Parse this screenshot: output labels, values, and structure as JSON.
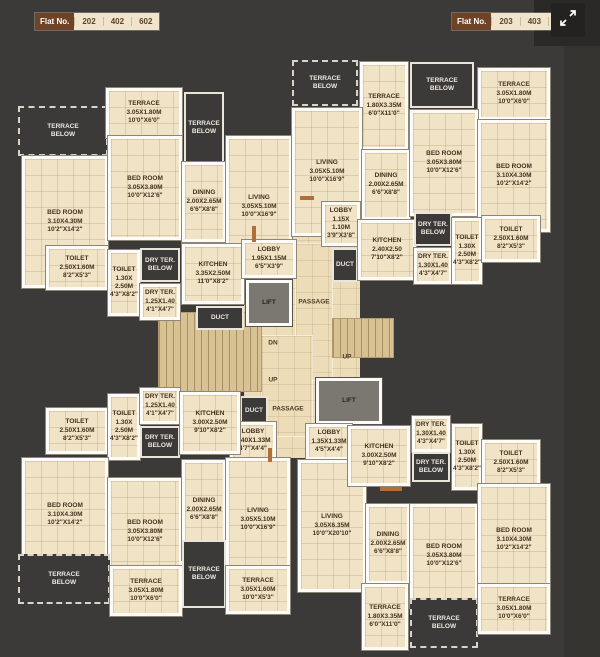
{
  "header": {
    "left_badge": {
      "label": "Flat No.",
      "numbers": [
        "202",
        "402",
        "602"
      ]
    },
    "right_badge": {
      "label": "Flat No.",
      "numbers": [
        "203",
        "403",
        "603"
      ]
    },
    "expand_icon": "expand-arrows-icon"
  },
  "colors": {
    "background": "#3b3a38",
    "room_cream": "#f1e3c6",
    "wall_white": "#fcfbf7",
    "badge_brown": "#6f4426",
    "lift_gray": "#7b7871",
    "stair_tan": "#d8c192",
    "label_brown": "#43321f"
  },
  "plan": {
    "rooms": [
      {
        "id": "core-floor-upper",
        "kind": "corefloor",
        "x": 244,
        "y": 208,
        "w": 116,
        "h": 250,
        "lines": []
      },
      {
        "id": "passage-upper",
        "kind": "passage",
        "x": 296,
        "y": 244,
        "w": 36,
        "h": 136,
        "lines": []
      },
      {
        "id": "passage-lower",
        "kind": "passage",
        "x": 262,
        "y": 336,
        "w": 50,
        "h": 100,
        "lines": []
      },
      {
        "id": "stair-left",
        "kind": "stair",
        "x": 158,
        "y": 312,
        "w": 104,
        "h": 80,
        "lines": []
      },
      {
        "id": "stair-right",
        "kind": "stair",
        "x": 332,
        "y": 318,
        "w": 62,
        "h": 40,
        "lines": []
      },
      {
        "id": "tl-terrace-below-left",
        "kind": "dark-dashed",
        "x": 18,
        "y": 106,
        "w": 90,
        "h": 50,
        "lines": [
          "TERRACE",
          "BELOW"
        ]
      },
      {
        "id": "tl-terrace",
        "kind": "room",
        "x": 106,
        "y": 88,
        "w": 76,
        "h": 50,
        "lines": [
          "TERRACE",
          "3.05X1.80M",
          "10'0\"X6'0\""
        ]
      },
      {
        "id": "tl-terrace-below-mid",
        "kind": "dark",
        "x": 184,
        "y": 92,
        "w": 40,
        "h": 72,
        "lines": [
          "TERRACE",
          "BELOW"
        ]
      },
      {
        "id": "tl-bedroom-left",
        "kind": "room",
        "x": 22,
        "y": 156,
        "w": 86,
        "h": 132,
        "lines": [
          "BED ROOM",
          "3.10X4.30M",
          "10'2\"X14'2\""
        ]
      },
      {
        "id": "tl-bedroom-mid",
        "kind": "room",
        "x": 108,
        "y": 136,
        "w": 74,
        "h": 104,
        "lines": [
          "BED ROOM",
          "3.05X3.80M",
          "10'0\"X12'6\""
        ]
      },
      {
        "id": "tl-dining",
        "kind": "room",
        "x": 182,
        "y": 162,
        "w": 44,
        "h": 80,
        "lines": [
          "DINING",
          "2.00X2.65M",
          "6'6\"X8'8\""
        ]
      },
      {
        "id": "tl-living",
        "kind": "room",
        "x": 226,
        "y": 136,
        "w": 66,
        "h": 142,
        "lines": [
          "LIVING",
          "3.05X5.10M",
          "10'0\"X16'9\""
        ]
      },
      {
        "id": "tl-toilet-1",
        "kind": "room",
        "x": 46,
        "y": 246,
        "w": 62,
        "h": 44,
        "lines": [
          "TOILET",
          "2.50X1.60M",
          "8'2\"X5'3\""
        ]
      },
      {
        "id": "tl-toilet-2",
        "kind": "room",
        "x": 108,
        "y": 250,
        "w": 32,
        "h": 66,
        "lines": [
          "TOILET",
          "1.30X",
          "2.50M",
          "4'3\"X8'2\""
        ]
      },
      {
        "id": "tl-dry-terrace-below",
        "kind": "dark",
        "x": 140,
        "y": 248,
        "w": 40,
        "h": 34,
        "lines": [
          "DRY TER.",
          "BELOW"
        ]
      },
      {
        "id": "tl-dry-terrace",
        "kind": "room",
        "x": 140,
        "y": 284,
        "w": 40,
        "h": 36,
        "lines": [
          "DRY TER.",
          "1.25X1.40",
          "4'1\"X4'7\""
        ]
      },
      {
        "id": "tl-kitchen",
        "kind": "room",
        "x": 182,
        "y": 244,
        "w": 62,
        "h": 60,
        "lines": [
          "KITCHEN",
          "3.35X2.50M",
          "11'0\"X8'2\""
        ]
      },
      {
        "id": "tl-duct",
        "kind": "dark",
        "x": 196,
        "y": 306,
        "w": 48,
        "h": 24,
        "lines": [
          "DUCT"
        ]
      },
      {
        "id": "tr-terrace-below-left",
        "kind": "dark-dashed",
        "x": 292,
        "y": 60,
        "w": 66,
        "h": 46,
        "lines": [
          "TERRACE",
          "BELOW"
        ]
      },
      {
        "id": "tr-terrace-tall",
        "kind": "room",
        "x": 360,
        "y": 62,
        "w": 48,
        "h": 88,
        "lines": [
          "TERRACE",
          "1.80X3.35M",
          "6'0\"X11'0\""
        ]
      },
      {
        "id": "tr-terrace-below-right",
        "kind": "dark",
        "x": 410,
        "y": 62,
        "w": 64,
        "h": 46,
        "lines": [
          "TERRACE",
          "BELOW"
        ]
      },
      {
        "id": "tr-terrace-right",
        "kind": "room",
        "x": 478,
        "y": 68,
        "w": 72,
        "h": 52,
        "lines": [
          "TERRACE",
          "3.05X1.80M",
          "10'0\"X6'0\""
        ]
      },
      {
        "id": "tr-living",
        "kind": "room",
        "x": 292,
        "y": 108,
        "w": 70,
        "h": 128,
        "lines": [
          "LIVING",
          "3.05X5.10M",
          "10'0\"X16'9\""
        ]
      },
      {
        "id": "tr-dining",
        "kind": "room",
        "x": 362,
        "y": 150,
        "w": 48,
        "h": 70,
        "lines": [
          "DINING",
          "2.00X2.65M",
          "6'6\"X8'8\""
        ]
      },
      {
        "id": "tr-bedroom-mid",
        "kind": "room",
        "x": 410,
        "y": 110,
        "w": 68,
        "h": 106,
        "lines": [
          "BED ROOM",
          "3.05X3.80M",
          "10'0\"X12'6\""
        ]
      },
      {
        "id": "tr-bedroom-right",
        "kind": "room",
        "x": 478,
        "y": 120,
        "w": 72,
        "h": 112,
        "lines": [
          "BED ROOM",
          "3.10X4.30M",
          "10'2\"X14'2\""
        ]
      },
      {
        "id": "core-lobby-1",
        "kind": "room",
        "x": 242,
        "y": 240,
        "w": 54,
        "h": 38,
        "lines": [
          "LOBBY",
          "1.95X1.15M",
          "6'5\"X3'9\""
        ]
      },
      {
        "id": "core-lift-1",
        "kind": "lift",
        "x": 246,
        "y": 280,
        "w": 46,
        "h": 46,
        "lines": [
          "LIFT"
        ]
      },
      {
        "id": "core-lobby-2",
        "kind": "room",
        "x": 322,
        "y": 202,
        "w": 38,
        "h": 44,
        "lines": [
          "LOBBY",
          "1.15X",
          "1.10M",
          "3'9\"X3'8\""
        ]
      },
      {
        "id": "core-duct-1",
        "kind": "dark",
        "x": 332,
        "y": 248,
        "w": 26,
        "h": 34,
        "lines": [
          "DUCT"
        ]
      },
      {
        "id": "core-kitchen-right",
        "kind": "room",
        "x": 358,
        "y": 220,
        "w": 58,
        "h": 60,
        "lines": [
          "KITCHEN",
          "2.40X2.50",
          "7'10\"X8'2\""
        ]
      },
      {
        "id": "core-dry-terrace-below-r",
        "kind": "dark",
        "x": 414,
        "y": 212,
        "w": 38,
        "h": 34,
        "lines": [
          "DRY TER.",
          "BELOW"
        ]
      },
      {
        "id": "core-dry-terrace-r",
        "kind": "room",
        "x": 414,
        "y": 248,
        "w": 38,
        "h": 36,
        "lines": [
          "DRY TER.",
          "1.30X1.40",
          "4'3\"X4'7\""
        ]
      },
      {
        "id": "tr-toilet-1",
        "kind": "room",
        "x": 452,
        "y": 218,
        "w": 30,
        "h": 66,
        "lines": [
          "TOILET",
          "1.30X",
          "2.50M",
          "4'3\"X8'2\""
        ]
      },
      {
        "id": "tr-toilet-2",
        "kind": "room",
        "x": 482,
        "y": 216,
        "w": 58,
        "h": 46,
        "lines": [
          "TOILET",
          "2.50X1.60M",
          "8'2\"X5'3\""
        ]
      },
      {
        "id": "core-lift-2",
        "kind": "lift",
        "x": 316,
        "y": 378,
        "w": 66,
        "h": 46,
        "lines": [
          "LIFT"
        ]
      },
      {
        "id": "core-duct-2",
        "kind": "dark",
        "x": 240,
        "y": 396,
        "w": 28,
        "h": 30,
        "lines": [
          "DUCT"
        ]
      },
      {
        "id": "core-lobby-3",
        "kind": "room",
        "x": 230,
        "y": 422,
        "w": 46,
        "h": 38,
        "lines": [
          "LOBBY",
          "1.40X1.33M",
          "4'7\"X4'4\""
        ]
      },
      {
        "id": "core-lobby-4",
        "kind": "room",
        "x": 306,
        "y": 424,
        "w": 46,
        "h": 36,
        "lines": [
          "LOBBY",
          "1.35X1.33M",
          "4'5\"X4'4\""
        ]
      },
      {
        "id": "bl-toilet-1",
        "kind": "room",
        "x": 46,
        "y": 408,
        "w": 62,
        "h": 46,
        "lines": [
          "TOILET",
          "2.50X1.60M",
          "8'2\"X5'3\""
        ]
      },
      {
        "id": "bl-toilet-2",
        "kind": "room",
        "x": 108,
        "y": 394,
        "w": 32,
        "h": 66,
        "lines": [
          "TOILET",
          "1.30X",
          "2.50M",
          "4'3\"X8'2\""
        ]
      },
      {
        "id": "bl-dry-terrace",
        "kind": "room",
        "x": 140,
        "y": 388,
        "w": 40,
        "h": 36,
        "lines": [
          "DRY TER.",
          "1.25X1.40",
          "4'1\"X4'7\""
        ]
      },
      {
        "id": "bl-dry-terrace-below",
        "kind": "dark",
        "x": 140,
        "y": 426,
        "w": 40,
        "h": 32,
        "lines": [
          "DRY TER.",
          "BELOW"
        ]
      },
      {
        "id": "bl-kitchen",
        "kind": "room",
        "x": 180,
        "y": 392,
        "w": 60,
        "h": 62,
        "lines": [
          "KITCHEN",
          "3.00X2.50M",
          "9'10\"X8'2\""
        ]
      },
      {
        "id": "bl-bedroom-left",
        "kind": "room",
        "x": 22,
        "y": 458,
        "w": 86,
        "h": 114,
        "lines": [
          "BED ROOM",
          "3.10X4.30M",
          "10'2\"X14'2\""
        ]
      },
      {
        "id": "bl-bedroom-mid",
        "kind": "room",
        "x": 108,
        "y": 478,
        "w": 74,
        "h": 108,
        "lines": [
          "BED ROOM",
          "3.05X3.80M",
          "10'0\"X12'6\""
        ]
      },
      {
        "id": "bl-dining",
        "kind": "room",
        "x": 182,
        "y": 460,
        "w": 44,
        "h": 100,
        "lines": [
          "DINING",
          "2.00X2.65M",
          "6'6\"X8'8\""
        ]
      },
      {
        "id": "bl-living",
        "kind": "room",
        "x": 226,
        "y": 458,
        "w": 64,
        "h": 124,
        "lines": [
          "LIVING",
          "3.05X5.10M",
          "10'0\"X16'9\""
        ]
      },
      {
        "id": "bl-terrace-below-left",
        "kind": "dark-dashed",
        "x": 18,
        "y": 554,
        "w": 92,
        "h": 50,
        "lines": [
          "TERRACE",
          "BELOW"
        ]
      },
      {
        "id": "bl-terrace",
        "kind": "room",
        "x": 110,
        "y": 566,
        "w": 72,
        "h": 50,
        "lines": [
          "TERRACE",
          "3.05X1.80M",
          "10'0\"X6'0\""
        ]
      },
      {
        "id": "bl-terrace-below-mid",
        "kind": "dark",
        "x": 182,
        "y": 540,
        "w": 44,
        "h": 68,
        "lines": [
          "TERRACE",
          "BELOW"
        ]
      },
      {
        "id": "bl-terrace-2",
        "kind": "room",
        "x": 226,
        "y": 566,
        "w": 64,
        "h": 48,
        "lines": [
          "TERRACE",
          "3.05X1.60M",
          "10'0\"X5'3\""
        ]
      },
      {
        "id": "br-living",
        "kind": "room",
        "x": 298,
        "y": 460,
        "w": 68,
        "h": 132,
        "lines": [
          "LIVING",
          "3.05X6.35M",
          "10'0\"X20'10\""
        ]
      },
      {
        "id": "br-kitchen",
        "kind": "room",
        "x": 348,
        "y": 426,
        "w": 62,
        "h": 60,
        "lines": [
          "KITCHEN",
          "3.00X2.50M",
          "9'10\"X8'2\""
        ]
      },
      {
        "id": "br-dry-terrace",
        "kind": "room",
        "x": 412,
        "y": 416,
        "w": 38,
        "h": 36,
        "lines": [
          "DRY TER.",
          "1.30X1.40",
          "4'3\"X4'7\""
        ]
      },
      {
        "id": "br-dry-terrace-below",
        "kind": "dark",
        "x": 412,
        "y": 452,
        "w": 38,
        "h": 30,
        "lines": [
          "DRY TER.",
          "BELOW"
        ]
      },
      {
        "id": "br-toilet-1",
        "kind": "room",
        "x": 452,
        "y": 424,
        "w": 30,
        "h": 66,
        "lines": [
          "TOILET",
          "1.30X",
          "2.50M",
          "4'3\"X8'2\""
        ]
      },
      {
        "id": "br-toilet-2",
        "kind": "room",
        "x": 482,
        "y": 440,
        "w": 58,
        "h": 46,
        "lines": [
          "TOILET",
          "2.50X1.60M",
          "8'2\"X5'3\""
        ]
      },
      {
        "id": "br-dining",
        "kind": "room",
        "x": 366,
        "y": 504,
        "w": 44,
        "h": 80,
        "lines": [
          "DINING",
          "2.00X2.65M",
          "6'6\"X8'8\""
        ]
      },
      {
        "id": "br-bedroom-mid",
        "kind": "room",
        "x": 410,
        "y": 504,
        "w": 68,
        "h": 104,
        "lines": [
          "BED ROOM",
          "3.05X3.80M",
          "10'0\"X12'6\""
        ]
      },
      {
        "id": "br-bedroom-right",
        "kind": "room",
        "x": 478,
        "y": 484,
        "w": 72,
        "h": 112,
        "lines": [
          "BED ROOM",
          "3.10X4.30M",
          "10'2\"X14'2\""
        ]
      },
      {
        "id": "br-terrace-tall",
        "kind": "room",
        "x": 362,
        "y": 584,
        "w": 46,
        "h": 66,
        "lines": [
          "TERRACE",
          "1.80X3.35M",
          "6'0\"X11'0\""
        ]
      },
      {
        "id": "br-terrace-below",
        "kind": "dark-dashed",
        "x": 410,
        "y": 598,
        "w": 68,
        "h": 50,
        "lines": [
          "TERRACE",
          "BELOW"
        ]
      },
      {
        "id": "br-terrace-right",
        "kind": "room",
        "x": 478,
        "y": 584,
        "w": 72,
        "h": 50,
        "lines": [
          "TERRACE",
          "3.05X1.80M",
          "10'0\"X6'0\""
        ]
      },
      {
        "id": "door-threshold-1",
        "kind": "accent",
        "x": 252,
        "y": 226,
        "w": 4,
        "h": 16,
        "lines": []
      },
      {
        "id": "door-threshold-2",
        "kind": "accent",
        "x": 300,
        "y": 196,
        "w": 14,
        "h": 4,
        "lines": []
      },
      {
        "id": "door-threshold-3",
        "kind": "accent",
        "x": 268,
        "y": 448,
        "w": 4,
        "h": 14,
        "lines": []
      },
      {
        "id": "door-threshold-4",
        "kind": "accent",
        "x": 380,
        "y": 487,
        "w": 22,
        "h": 4,
        "lines": []
      }
    ],
    "free_labels": [
      {
        "text": "DN",
        "x": 273,
        "y": 343
      },
      {
        "text": "UP",
        "x": 347,
        "y": 357
      },
      {
        "text": "UP",
        "x": 273,
        "y": 380
      },
      {
        "text": "PASSAGE",
        "x": 314,
        "y": 302
      },
      {
        "text": "PASSAGE",
        "x": 288,
        "y": 409
      }
    ]
  }
}
